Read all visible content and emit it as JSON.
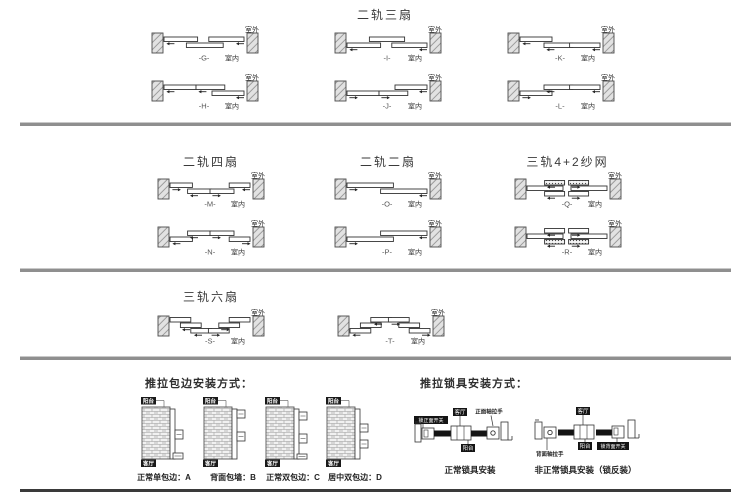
{
  "titles": {
    "s1": "二轨三扇",
    "s2a": "二轨四扇",
    "s2b": "二轨二扇",
    "s2c": "三轨4+2纱网",
    "s3": "三轨六扇",
    "wrap_header": "推拉包边安装方式：",
    "lock_header": "推拉锁具安装方式："
  },
  "labels": {
    "outdoor": "室外",
    "indoor": "室内",
    "balcony": "阳台",
    "room": "客厅"
  },
  "slide_diagrams": [
    {
      "code": "-G-",
      "panels": [
        {
          "lvl": 0,
          "x0": 0.0,
          "x1": 0.42
        },
        {
          "lvl": 1,
          "x0": 0.28,
          "x1": 0.74
        },
        {
          "lvl": 0,
          "x0": 0.56,
          "x1": 1.0
        }
      ],
      "arrows": [
        {
          "x": 0.03,
          "lvl": 0,
          "dir": "left"
        },
        {
          "x": 0.9,
          "lvl": 0,
          "dir": "left"
        }
      ]
    },
    {
      "code": "-H-",
      "panels": [
        {
          "lvl": 0,
          "x0": 0.0,
          "x1": 0.4
        },
        {
          "lvl": 0,
          "x0": 0.4,
          "x1": 0.76
        },
        {
          "lvl": 1,
          "x0": 0.6,
          "x1": 1.0
        }
      ],
      "arrows": [
        {
          "x": 0.03,
          "lvl": 0,
          "dir": "left"
        },
        {
          "x": 0.43,
          "lvl": 0,
          "dir": "left"
        },
        {
          "x": 0.9,
          "lvl": 1,
          "dir": "left"
        }
      ]
    },
    {
      "code": "-I-",
      "panels": [
        {
          "lvl": 0,
          "x0": 0.28,
          "x1": 0.72
        },
        {
          "lvl": 1,
          "x0": 0.0,
          "x1": 0.42
        },
        {
          "lvl": 1,
          "x0": 0.56,
          "x1": 1.0
        }
      ],
      "arrows": [
        {
          "x": 0.03,
          "lvl": 1,
          "dir": "left"
        },
        {
          "x": 0.9,
          "lvl": 1,
          "dir": "left"
        }
      ]
    },
    {
      "code": "-J-",
      "panels": [
        {
          "lvl": 1,
          "x0": 0.0,
          "x1": 0.4
        },
        {
          "lvl": 1,
          "x0": 0.4,
          "x1": 0.76
        },
        {
          "lvl": 0,
          "x0": 0.6,
          "x1": 1.0
        }
      ],
      "arrows": [
        {
          "x": 0.03,
          "lvl": 1,
          "dir": "right"
        },
        {
          "x": 0.43,
          "lvl": 1,
          "dir": "right"
        },
        {
          "x": 0.9,
          "lvl": 0,
          "dir": "left"
        }
      ]
    },
    {
      "code": "-K-",
      "panels": [
        {
          "lvl": 0,
          "x0": 0.0,
          "x1": 0.4
        },
        {
          "lvl": 1,
          "x0": 0.3,
          "x1": 0.66
        },
        {
          "lvl": 1,
          "x0": 0.62,
          "x1": 1.0
        }
      ],
      "arrows": [
        {
          "x": 0.03,
          "lvl": 0,
          "dir": "left"
        },
        {
          "x": 0.33,
          "lvl": 1,
          "dir": "left"
        },
        {
          "x": 0.9,
          "lvl": 1,
          "dir": "left"
        }
      ]
    },
    {
      "code": "-L-",
      "panels": [
        {
          "lvl": 1,
          "x0": 0.0,
          "x1": 0.4
        },
        {
          "lvl": 0,
          "x0": 0.3,
          "x1": 0.66
        },
        {
          "lvl": 0,
          "x0": 0.62,
          "x1": 1.0
        }
      ],
      "arrows": [
        {
          "x": 0.03,
          "lvl": 1,
          "dir": "right"
        },
        {
          "x": 0.33,
          "lvl": 0,
          "dir": "left"
        },
        {
          "x": 0.9,
          "lvl": 0,
          "dir": "left"
        }
      ]
    },
    {
      "code": "-M-",
      "panels": [
        {
          "lvl": 0,
          "x0": 0.0,
          "x1": 0.28
        },
        {
          "lvl": 1,
          "x0": 0.22,
          "x1": 0.52
        },
        {
          "lvl": 1,
          "x0": 0.5,
          "x1": 0.8
        },
        {
          "lvl": 0,
          "x0": 0.74,
          "x1": 1.0
        }
      ],
      "arrows": [
        {
          "x": 0.03,
          "lvl": 0,
          "dir": "right"
        },
        {
          "x": 0.25,
          "lvl": 1,
          "dir": "left"
        },
        {
          "x": 0.53,
          "lvl": 1,
          "dir": "right"
        },
        {
          "x": 0.9,
          "lvl": 0,
          "dir": "left"
        }
      ]
    },
    {
      "code": "-N-",
      "panels": [
        {
          "lvl": 1,
          "x0": 0.0,
          "x1": 0.28
        },
        {
          "lvl": 0,
          "x0": 0.22,
          "x1": 0.52
        },
        {
          "lvl": 0,
          "x0": 0.5,
          "x1": 0.8
        },
        {
          "lvl": 1,
          "x0": 0.74,
          "x1": 1.0
        }
      ],
      "arrows": [
        {
          "x": 0.03,
          "lvl": 1,
          "dir": "left"
        },
        {
          "x": 0.25,
          "lvl": 0,
          "dir": "left"
        },
        {
          "x": 0.53,
          "lvl": 0,
          "dir": "right"
        },
        {
          "x": 0.9,
          "lvl": 1,
          "dir": "right"
        }
      ]
    },
    {
      "code": "-O-",
      "panels": [
        {
          "lvl": 0,
          "x0": 0.0,
          "x1": 0.58
        },
        {
          "lvl": 1,
          "x0": 0.42,
          "x1": 1.0
        }
      ],
      "arrows": [
        {
          "x": 0.03,
          "lvl": 0,
          "dir": "right"
        },
        {
          "x": 0.9,
          "lvl": 1,
          "dir": "left"
        }
      ]
    },
    {
      "code": "-P-",
      "panels": [
        {
          "lvl": 1,
          "x0": 0.0,
          "x1": 0.58
        },
        {
          "lvl": 0,
          "x0": 0.42,
          "x1": 1.0
        }
      ],
      "arrows": [
        {
          "x": 0.03,
          "lvl": 1,
          "dir": "right"
        },
        {
          "x": 0.9,
          "lvl": 0,
          "dir": "left"
        }
      ]
    },
    {
      "code": "-Q-",
      "panels": [
        {
          "lvl": 0,
          "x0": 0.22,
          "x1": 0.47,
          "screen": true
        },
        {
          "lvl": 0,
          "x0": 0.52,
          "x1": 0.77,
          "screen": true
        },
        {
          "lvl": 1,
          "x0": 0.0,
          "x1": 0.45
        },
        {
          "lvl": 1,
          "x0": 0.55,
          "x1": 1.0
        },
        {
          "lvl": 2,
          "x0": 0.22,
          "x1": 0.47
        },
        {
          "lvl": 2,
          "x0": 0.52,
          "x1": 0.77
        }
      ],
      "arrows": [
        {
          "x": 0.25,
          "lvl": 0,
          "dir": "left"
        },
        {
          "x": 0.56,
          "lvl": 0,
          "dir": "right"
        },
        {
          "x": 0.25,
          "lvl": 2,
          "dir": "left"
        },
        {
          "x": 0.56,
          "lvl": 2,
          "dir": "right"
        }
      ]
    },
    {
      "code": "-R-",
      "panels": [
        {
          "lvl": 0,
          "x0": 0.22,
          "x1": 0.47
        },
        {
          "lvl": 0,
          "x0": 0.52,
          "x1": 0.77
        },
        {
          "lvl": 1,
          "x0": 0.0,
          "x1": 0.45
        },
        {
          "lvl": 1,
          "x0": 0.55,
          "x1": 1.0
        },
        {
          "lvl": 2,
          "x0": 0.22,
          "x1": 0.47,
          "screen": true
        },
        {
          "lvl": 2,
          "x0": 0.52,
          "x1": 0.77,
          "screen": true
        }
      ],
      "arrows": [
        {
          "x": 0.25,
          "lvl": 0,
          "dir": "left"
        },
        {
          "x": 0.56,
          "lvl": 0,
          "dir": "right"
        },
        {
          "x": 0.25,
          "lvl": 2,
          "dir": "left"
        },
        {
          "x": 0.56,
          "lvl": 2,
          "dir": "right"
        }
      ]
    },
    {
      "code": "-S-",
      "panels": [
        {
          "lvl": 0,
          "x0": 0.0,
          "x1": 0.26
        },
        {
          "lvl": 1,
          "x0": 0.13,
          "x1": 0.39
        },
        {
          "lvl": 2,
          "x0": 0.26,
          "x1": 0.52
        },
        {
          "lvl": 2,
          "x0": 0.48,
          "x1": 0.74
        },
        {
          "lvl": 1,
          "x0": 0.61,
          "x1": 0.87
        },
        {
          "lvl": 0,
          "x0": 0.74,
          "x1": 1.0
        }
      ],
      "arrows": [
        {
          "x": 0.15,
          "lvl": 1,
          "dir": "left"
        },
        {
          "x": 0.3,
          "lvl": 2,
          "dir": "left"
        },
        {
          "x": 0.52,
          "lvl": 2,
          "dir": "right"
        },
        {
          "x": 0.64,
          "lvl": 1,
          "dir": "right"
        }
      ]
    },
    {
      "code": "-T-",
      "panels": [
        {
          "lvl": 2,
          "x0": 0.0,
          "x1": 0.26
        },
        {
          "lvl": 1,
          "x0": 0.13,
          "x1": 0.39
        },
        {
          "lvl": 0,
          "x0": 0.26,
          "x1": 0.52
        },
        {
          "lvl": 0,
          "x0": 0.48,
          "x1": 0.74
        },
        {
          "lvl": 1,
          "x0": 0.61,
          "x1": 0.87
        },
        {
          "lvl": 2,
          "x0": 0.74,
          "x1": 1.0
        }
      ],
      "arrows": [
        {
          "x": 0.03,
          "lvl": 2,
          "dir": "left"
        },
        {
          "x": 0.3,
          "lvl": 0,
          "dir": "left"
        },
        {
          "x": 0.52,
          "lvl": 0,
          "dir": "right"
        },
        {
          "x": 0.9,
          "lvl": 2,
          "dir": "right"
        }
      ]
    }
  ],
  "wrap_items": [
    {
      "top": "阳台",
      "bottom": "客厅",
      "label": "正常单包边：A"
    },
    {
      "top": "阳台",
      "bottom": "客厅",
      "label": "背面包墙：B"
    },
    {
      "top": "阳台",
      "bottom": "客厅",
      "label": "正常双包边：C"
    },
    {
      "top": "阳台",
      "bottom": "客厅",
      "label": "居中双包边：D"
    }
  ],
  "lock_items": [
    {
      "label": "正常锁具安装",
      "annotations": {
        "lock": "锁正面开关",
        "room": "客厅",
        "handle": "正面轴拉手",
        "balcony": "阳台"
      }
    },
    {
      "label": "非正常锁具安装（锁反装）",
      "annotations": {
        "handle": "背面轴拉手",
        "room": "客厅",
        "balcony": "阳台",
        "lock": "锁背面开关"
      }
    }
  ]
}
